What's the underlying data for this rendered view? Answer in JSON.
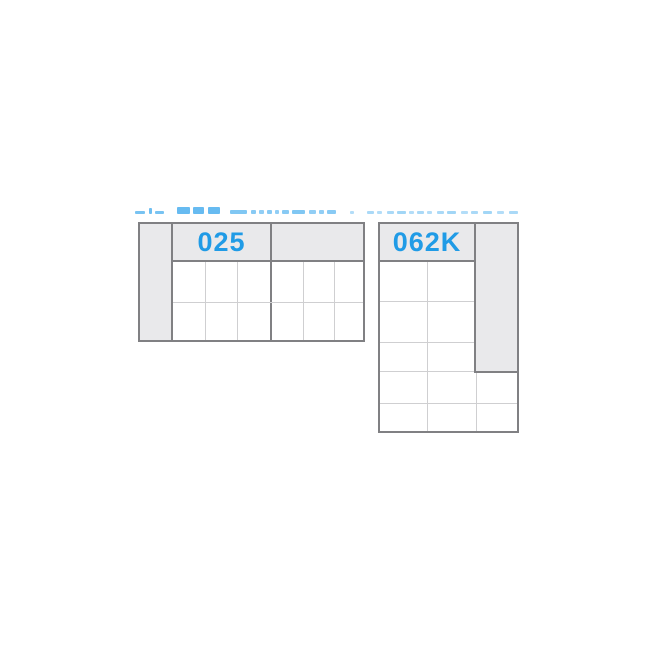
{
  "diagram": {
    "modules": [
      {
        "label": "025",
        "armrest_side": "left",
        "backrest_sections": 2,
        "seat_grid": {
          "columns": 6,
          "rows": 2
        }
      },
      {
        "label": "062K",
        "armrest_side": "right",
        "backrest_sections": 1,
        "seat_grid": {
          "columns": 2,
          "rows": 5,
          "extra_columns_below_armrest": 1
        }
      }
    ]
  },
  "colors": {
    "accent_blue": "#209be6",
    "remnant_blue": "#56b4ef",
    "panel_fill": "#e9e9eb",
    "border_dark": "#808083",
    "grid_line": "#cfcfd1",
    "background": "#ffffff"
  }
}
